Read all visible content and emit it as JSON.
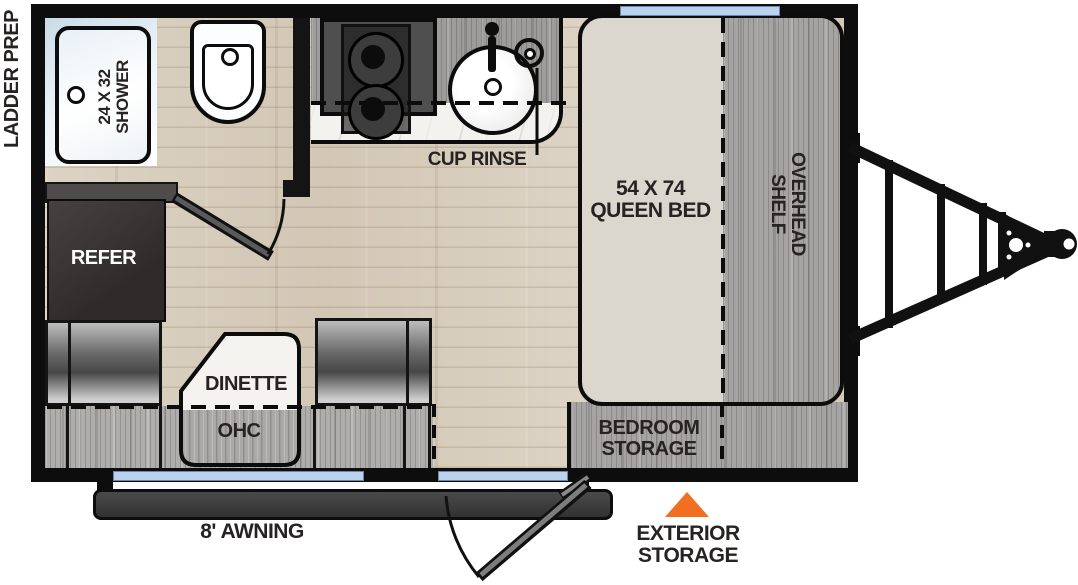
{
  "labels": {
    "ladder_prep": "LADDER PREP",
    "shower_size": "24 X 32",
    "shower_name": "SHOWER",
    "cup_rinse": "CUP RINSE",
    "bed_size": "54 X 74",
    "bed_name": "QUEEN BED",
    "overhead_line1": "OVERHEAD",
    "overhead_line2": "SHELF",
    "refer": "REFER",
    "dinette": "DINETTE",
    "ohc": "OHC",
    "bedroom_storage_line1": "BEDROOM",
    "bedroom_storage_line2": "STORAGE",
    "awning": "8' AWNING",
    "exterior_line1": "EXTERIOR",
    "exterior_line2": "STORAGE"
  },
  "colors": {
    "wall": "#0D0D0D",
    "window": "#BBD2EE",
    "exterior_storage_marker": "#F26E21",
    "floor_wood": "#D7CCBD",
    "cabinet_wood_gray": "#A5A4A2",
    "mattress": "#DBD7CE",
    "label_text": "#262322",
    "refer_text": "#FFFFFF"
  }
}
